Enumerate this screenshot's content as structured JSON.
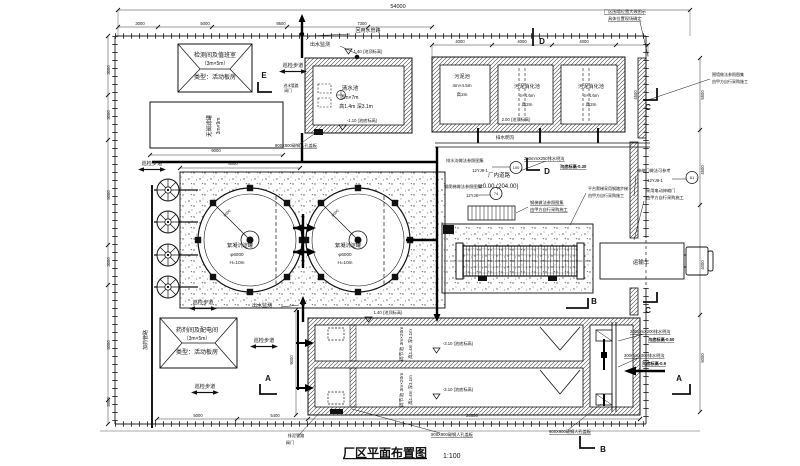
{
  "drawing": {
    "title": "厂区平面布置图",
    "scale": "1:100"
  },
  "labels": [
    {
      "n": "dim-overall",
      "t": "54000",
      "x": 398,
      "y": 8,
      "s": 5.5
    },
    {
      "n": "dim",
      "t": "3000",
      "x": 140,
      "y": 25,
      "s": 4.2
    },
    {
      "n": "dim",
      "t": "5000",
      "x": 205,
      "y": 25,
      "s": 4.2
    },
    {
      "n": "dim",
      "t": "9500",
      "x": 281,
      "y": 25,
      "s": 4.2
    },
    {
      "n": "dim",
      "t": "7300",
      "x": 362,
      "y": 25,
      "s": 4.2
    },
    {
      "n": "dim",
      "t": "4000",
      "x": 460,
      "y": 43,
      "s": 4.2
    },
    {
      "n": "dim",
      "t": "4000",
      "x": 522,
      "y": 43,
      "s": 4.2
    },
    {
      "n": "dim",
      "t": "4000",
      "x": 584,
      "y": 43,
      "s": 4.2
    },
    {
      "n": "dim",
      "t": "3000",
      "x": 110,
      "y": 70,
      "s": 4.2,
      "r": -90
    },
    {
      "n": "dim",
      "t": "3000",
      "x": 110,
      "y": 115,
      "s": 4.2,
      "r": -90
    },
    {
      "n": "dim",
      "t": "5000",
      "x": 110,
      "y": 195,
      "s": 4.2,
      "r": -90
    },
    {
      "n": "dim",
      "t": "3000",
      "x": 110,
      "y": 262,
      "s": 4.2,
      "r": -90
    },
    {
      "n": "dim",
      "t": "5000",
      "x": 110,
      "y": 345,
      "s": 4.2,
      "r": -90
    },
    {
      "n": "dim",
      "t": "2000",
      "x": 110,
      "y": 402,
      "s": 4.2,
      "r": -90
    },
    {
      "n": "dim",
      "t": "5500",
      "x": 704,
      "y": 95,
      "s": 4.2,
      "r": -90
    },
    {
      "n": "dim",
      "t": "4500",
      "x": 704,
      "y": 170,
      "s": 4.2,
      "r": -90
    },
    {
      "n": "dim",
      "t": "4000",
      "x": 704,
      "y": 265,
      "s": 4.2,
      "r": -90
    },
    {
      "n": "dim",
      "t": "5000",
      "x": 704,
      "y": 358,
      "s": 4.2,
      "r": -90
    },
    {
      "n": "dim",
      "t": "4500",
      "x": 637,
      "y": 95,
      "s": 4.2,
      "r": -90
    },
    {
      "n": "dim",
      "t": "9000",
      "x": 216,
      "y": 152,
      "s": 4.2
    },
    {
      "n": "dim",
      "t": "8000",
      "x": 233,
      "y": 165,
      "s": 4.2
    },
    {
      "n": "dim",
      "t": "9000",
      "x": 293,
      "y": 360,
      "s": 4.2,
      "r": -90
    },
    {
      "n": "dim",
      "t": "20000",
      "x": 472,
      "y": 417,
      "s": 4.2
    },
    {
      "n": "dim",
      "t": "5000",
      "x": 198,
      "y": 417,
      "s": 4.2
    },
    {
      "n": "dim",
      "t": "5400",
      "x": 275,
      "y": 417,
      "s": 4.2
    },
    {
      "n": "building-monitor-room-name",
      "t": "检测间及值班室",
      "x": 215,
      "y": 57,
      "s": 6
    },
    {
      "n": "building-monitor-room-size",
      "t": "（3m×5m）",
      "x": 215,
      "y": 65,
      "s": 5
    },
    {
      "n": "building-monitor-room-type",
      "t": "类型：活动板房",
      "x": 215,
      "y": 79,
      "s": 6
    },
    {
      "n": "building-chem-room-name",
      "t": "药剂间及配电间",
      "x": 197,
      "y": 332,
      "s": 6
    },
    {
      "n": "building-chem-room-size",
      "t": "（3m×5m）",
      "x": 197,
      "y": 340,
      "s": 5
    },
    {
      "n": "building-chem-room-type",
      "t": "类型：活动板房",
      "x": 197,
      "y": 354,
      "s": 6
    },
    {
      "n": "filter-tank-name",
      "t": "无阀滤罐",
      "x": 211,
      "y": 126,
      "s": 5.5,
      "r": -90
    },
    {
      "n": "filter-tank-size",
      "t": "3m×9m",
      "x": 220,
      "y": 126,
      "s": 5,
      "r": -90
    },
    {
      "n": "elev",
      "t": "1.40 (池顶标高)",
      "x": 368,
      "y": 53,
      "s": 4.2,
      "tri": [
        345,
        49
      ]
    },
    {
      "n": "clearwater-name",
      "t": "清水池",
      "x": 350,
      "y": 90,
      "s": 5.5
    },
    {
      "n": "clearwater-size",
      "t": "5m×7m",
      "x": 350,
      "y": 99,
      "s": 5
    },
    {
      "n": "clearwater-depth",
      "t": "高1.4m 深3.1m",
      "x": 356,
      "y": 108,
      "s": 5
    },
    {
      "n": "elev",
      "t": "-1.10 (池底标高)",
      "x": 362,
      "y": 122,
      "s": 4.2,
      "tri": [
        339,
        125
      ]
    },
    {
      "n": "sludge-tank-name",
      "t": "污泥池",
      "x": 462,
      "y": 78,
      "s": 5.2
    },
    {
      "n": "sludge-tank-size",
      "t": "4m×4.5m",
      "x": 462,
      "y": 87,
      "s": 4.6
    },
    {
      "n": "sludge-tank-h",
      "t": "高2m",
      "x": 462,
      "y": 96,
      "s": 4.6
    },
    {
      "n": "digester-1-name",
      "t": "污泥消化池",
      "x": 527,
      "y": 88,
      "s": 5.2
    },
    {
      "n": "digester-1-size",
      "t": "4×4.6m",
      "x": 527,
      "y": 97,
      "s": 4.6
    },
    {
      "n": "digester-1-h",
      "t": "高2m",
      "x": 527,
      "y": 106,
      "s": 4.6
    },
    {
      "n": "digester-2-name",
      "t": "污泥消化池",
      "x": 591,
      "y": 88,
      "s": 5.2
    },
    {
      "n": "digester-2-size",
      "t": "4×4.6m",
      "x": 591,
      "y": 97,
      "s": 4.6
    },
    {
      "n": "digester-2-h",
      "t": "高2m",
      "x": 591,
      "y": 106,
      "s": 4.6
    },
    {
      "n": "elev",
      "t": "2.00 (池顶标高)",
      "x": 516,
      "y": 121,
      "s": 4.2
    },
    {
      "n": "open-drain-label",
      "t": "排水明沟",
      "x": 505,
      "y": 139,
      "s": 4.6
    },
    {
      "n": "clarifier-1-name",
      "t": "絮凝沉淀罐",
      "x": 240,
      "y": 247,
      "s": 5.2
    },
    {
      "n": "clarifier-1-dia",
      "t": "φ6000",
      "x": 237,
      "y": 256,
      "s": 4.6
    },
    {
      "n": "clarifier-1-h",
      "t": "H=10m",
      "x": 237,
      "y": 264,
      "s": 4.6
    },
    {
      "n": "clarifier-2-name",
      "t": "絮凝沉淀罐",
      "x": 348,
      "y": 247,
      "s": 5.2
    },
    {
      "n": "clarifier-2-dia",
      "t": "φ6000",
      "x": 345,
      "y": 256,
      "s": 4.6
    },
    {
      "n": "clarifier-2-h",
      "t": "H=10m",
      "x": 345,
      "y": 264,
      "s": 4.6
    },
    {
      "n": "dim",
      "t": "6000",
      "x": 228,
      "y": 214,
      "s": 3.8,
      "r": -45
    },
    {
      "n": "dim",
      "t": "6000",
      "x": 336,
      "y": 214,
      "s": 3.8,
      "r": -45
    },
    {
      "n": "eq-basin-1-name",
      "t": "调节池 3m×20m",
      "x": 403,
      "y": 344,
      "s": 4.8,
      "r": -90
    },
    {
      "n": "eq-basin-1-size",
      "t": "高1.4m 深3.1m",
      "x": 412,
      "y": 344,
      "s": 4.4,
      "r": -90
    },
    {
      "n": "eq-basin-2-name",
      "t": "调节池 3m×20m",
      "x": 403,
      "y": 390,
      "s": 4.8,
      "r": -90
    },
    {
      "n": "eq-basin-2-size",
      "t": "高1.4m 深3.1m",
      "x": 412,
      "y": 390,
      "s": 4.4,
      "r": -90
    },
    {
      "n": "elev",
      "t": "-3.10 (池底标高)",
      "x": 458,
      "y": 345,
      "s": 4.2,
      "tri": [
        433,
        348
      ]
    },
    {
      "n": "elev",
      "t": "-3.10 (池底标高)",
      "x": 458,
      "y": 391,
      "s": 4.2,
      "tri": [
        433,
        394
      ]
    },
    {
      "n": "elev",
      "t": "1.40 (池顶标高)",
      "x": 388,
      "y": 314,
      "s": 4.2,
      "tri": [
        365,
        317
      ]
    },
    {
      "n": "walkway-label",
      "t": "巡检步道",
      "x": 293,
      "y": 67,
      "s": 5.2,
      "arrow": true
    },
    {
      "n": "walkway-label",
      "t": "巡检步道",
      "x": 152,
      "y": 165,
      "s": 5.2,
      "arrow": true
    },
    {
      "n": "walkway-label",
      "t": "巡检步道",
      "x": 203,
      "y": 304,
      "s": 5.2,
      "arrow": true
    },
    {
      "n": "walkway-label",
      "t": "巡检步道",
      "x": 264,
      "y": 342,
      "s": 5.2,
      "arrow": true
    },
    {
      "n": "walkway-label",
      "t": "巡检步道",
      "x": 205,
      "y": 388,
      "s": 5.2,
      "arrow": true
    },
    {
      "n": "outlet-monitor-label",
      "t": "出水监测",
      "x": 320,
      "y": 46,
      "s": 5,
      "dot": [
        357,
        57
      ]
    },
    {
      "n": "outlet-monitor-label",
      "t": "出水监测",
      "x": 262,
      "y": 307,
      "s": 5,
      "dot": [
        303,
        303
      ]
    },
    {
      "n": "reuse-pipe-label",
      "t": "回用水管路",
      "x": 368,
      "y": 32,
      "s": 5
    },
    {
      "n": "dosing-pipe-label",
      "t": "加药管路",
      "x": 147,
      "y": 340,
      "s": 5,
      "r": -90
    },
    {
      "n": "mud-pipe-label",
      "t": "进水管路",
      "x": 291,
      "y": 87,
      "s": 3.8
    },
    {
      "n": "valve-label",
      "t": "阀门",
      "x": 288,
      "y": 92,
      "s": 3.8
    },
    {
      "n": "mud-pipe-label",
      "t": "排泥管路",
      "x": 296,
      "y": 437,
      "s": 4.2
    },
    {
      "n": "valve-label",
      "t": "阀门",
      "x": 290,
      "y": 444,
      "s": 4.2
    },
    {
      "n": "road-label",
      "t": "厂内道路",
      "x": 499,
      "y": 177,
      "s": 5.5
    },
    {
      "n": "road-elev",
      "t": "±0.00 (204.00)",
      "x": 499,
      "y": 188,
      "s": 6
    },
    {
      "n": "truck-label",
      "t": "运输车",
      "x": 641,
      "y": 264,
      "s": 5.5
    },
    {
      "n": "callout-drain-note",
      "t": "排水沟做法参照图集",
      "x": 446,
      "y": 162,
      "s": 4.2,
      "a": "start"
    },
    {
      "n": "callout-atlas",
      "t": "12YJ9-1",
      "x": 480,
      "y": 172,
      "s": 4.2
    },
    {
      "n": "callout-page",
      "t": "100",
      "x": 516,
      "y": 169,
      "s": 4
    },
    {
      "n": "callout-ladder-note",
      "t": "钢爬梯做法参照图集",
      "x": 444,
      "y": 188,
      "s": 4.2,
      "a": "start"
    },
    {
      "n": "callout-atlas",
      "t": "12YJ8",
      "x": 472,
      "y": 197,
      "s": 4.2
    },
    {
      "n": "callout-page",
      "t": "74",
      "x": 496,
      "y": 195,
      "s": 4
    },
    {
      "n": "callout-gate-note",
      "t": "伸缩门做法可参考",
      "x": 637,
      "y": 172,
      "s": 4.2,
      "a": "start"
    },
    {
      "n": "callout-atlas",
      "t": "12YJ9-1",
      "x": 655,
      "y": 182,
      "s": 4.2
    },
    {
      "n": "callout-page",
      "t": "61",
      "x": 692,
      "y": 179,
      "s": 4
    },
    {
      "n": "note",
      "t": "采用电动伸缩门",
      "x": 646,
      "y": 192,
      "s": 4.2,
      "a": "start"
    },
    {
      "n": "note",
      "t": "由甲方自行采购施工",
      "x": 646,
      "y": 199,
      "s": 4.2,
      "a": "start"
    },
    {
      "n": "note",
      "t": "厂区围墙位置大致图示",
      "x": 604,
      "y": 13,
      "s": 4.2,
      "a": "start",
      "ul": true
    },
    {
      "n": "note",
      "t": "具体位置现场确定",
      "x": 608,
      "y": 20,
      "s": 4.2,
      "a": "start",
      "ul": true
    },
    {
      "n": "note",
      "t": "围墙做法参照图集",
      "x": 712,
      "y": 76,
      "s": 4,
      "a": "start"
    },
    {
      "n": "note",
      "t": "由甲方自行采购施工",
      "x": 712,
      "y": 83,
      "s": 4,
      "a": "start"
    },
    {
      "n": "note",
      "t": "钢梯做法参照图集",
      "x": 530,
      "y": 204,
      "s": 4.2,
      "a": "start",
      "ul": true
    },
    {
      "n": "note",
      "t": "由甲方自行采购施工",
      "x": 530,
      "y": 211,
      "s": 4.2,
      "a": "start",
      "ul": true
    },
    {
      "n": "note",
      "t": "平台爬梯采用钢踏步梯",
      "x": 588,
      "y": 190,
      "s": 4,
      "a": "start"
    },
    {
      "n": "note",
      "t": "由甲方自行采购施工",
      "x": 588,
      "y": 197,
      "s": 4,
      "a": "start"
    },
    {
      "n": "drain-callout",
      "t": "250mmX250排水明沟",
      "x": 524,
      "y": 160,
      "s": 4.2,
      "a": "start",
      "ul": true
    },
    {
      "n": "drain-elev",
      "t": "沟底标高-0.30",
      "x": 560,
      "y": 168,
      "s": 4.2,
      "a": "start",
      "ul": true,
      "b": true
    },
    {
      "n": "drain-callout",
      "t": "200mmX200排水明沟",
      "x": 630,
      "y": 333,
      "s": 4.2,
      "a": "start",
      "ul": true
    },
    {
      "n": "drain-elev",
      "t": "沟底标高-0.50",
      "x": 648,
      "y": 341,
      "s": 4.2,
      "a": "start",
      "ul": true,
      "b": true
    },
    {
      "n": "drain-callout",
      "t": "300mmX300排水明沟",
      "x": 624,
      "y": 357,
      "s": 4.2,
      "a": "start",
      "ul": true
    },
    {
      "n": "drain-elev",
      "t": "沟底标高-0.9",
      "x": 642,
      "y": 365,
      "s": 4.2,
      "a": "start",
      "ul": true,
      "b": true
    },
    {
      "n": "manhole-callout",
      "t": "900X900碳钢人孔盖板",
      "x": 296,
      "y": 147,
      "s": 4.2,
      "ul": true
    },
    {
      "n": "manhole-callout",
      "t": "900X900碳钢人孔盖板",
      "x": 452,
      "y": 436,
      "s": 4.2,
      "ul": true
    },
    {
      "n": "manhole-callout",
      "t": "900X900碳钢人孔盖板",
      "x": 570,
      "y": 433,
      "s": 4.2,
      "ul": true
    },
    {
      "n": "section-marker",
      "t": "A",
      "x": 268,
      "y": 381,
      "s": 8,
      "b": true
    },
    {
      "n": "section-marker",
      "t": "A",
      "x": 679,
      "y": 381,
      "s": 8,
      "b": true
    },
    {
      "n": "section-marker",
      "t": "B",
      "x": 594,
      "y": 304,
      "s": 8,
      "b": true
    },
    {
      "n": "section-marker",
      "t": "B",
      "x": 603,
      "y": 452,
      "s": 8,
      "b": true
    },
    {
      "n": "section-marker",
      "t": "C",
      "x": 648,
      "y": 110,
      "s": 8,
      "b": true
    },
    {
      "n": "section-marker",
      "t": "C",
      "x": 648,
      "y": 313,
      "s": 8,
      "b": true
    },
    {
      "n": "section-marker",
      "t": "D",
      "x": 542,
      "y": 44,
      "s": 8,
      "b": true
    },
    {
      "n": "section-marker",
      "t": "D",
      "x": 547,
      "y": 174,
      "s": 8,
      "b": true
    },
    {
      "n": "section-marker",
      "t": "E",
      "x": 264,
      "y": 78,
      "s": 8,
      "b": true
    },
    {
      "n": "drawing-title",
      "t": "厂区平面布置图",
      "x": 385,
      "y": 457,
      "s": 12,
      "b": true,
      "ul": true
    },
    {
      "n": "drawing-scale",
      "t": "1:100",
      "x": 443,
      "y": 458,
      "s": 7,
      "a": "start"
    }
  ]
}
